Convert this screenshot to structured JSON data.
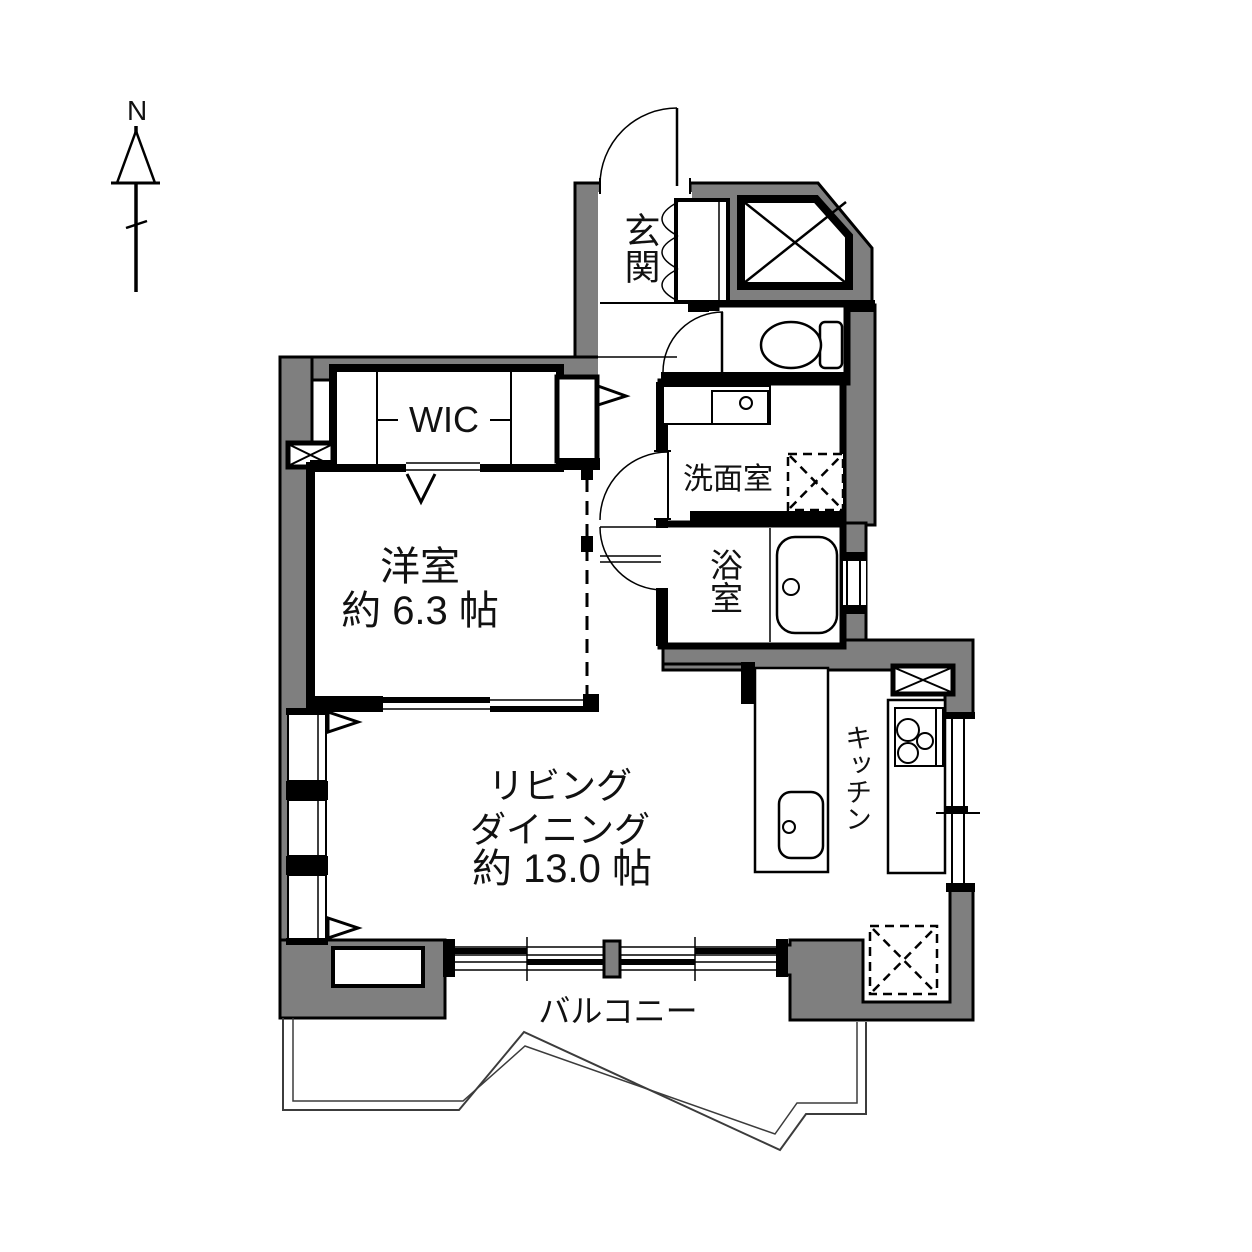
{
  "compass": {
    "label": "N"
  },
  "rooms": {
    "entrance": {
      "label": "玄関"
    },
    "wic": {
      "label": "WIC"
    },
    "western_room": {
      "label": "洋室",
      "size": "約 6.3 帖"
    },
    "living_dining": {
      "label_line1": "リビング",
      "label_line2": "ダイニング",
      "size": "約 13.0 帖"
    },
    "kitchen": {
      "label": "キッチン"
    },
    "washroom": {
      "label": "洗面室"
    },
    "bathroom": {
      "label": "浴室"
    },
    "balcony": {
      "label": "バルコニー"
    }
  },
  "colors": {
    "wall_gray": "#7f7f7f",
    "line_black": "#000000",
    "background": "#ffffff"
  }
}
